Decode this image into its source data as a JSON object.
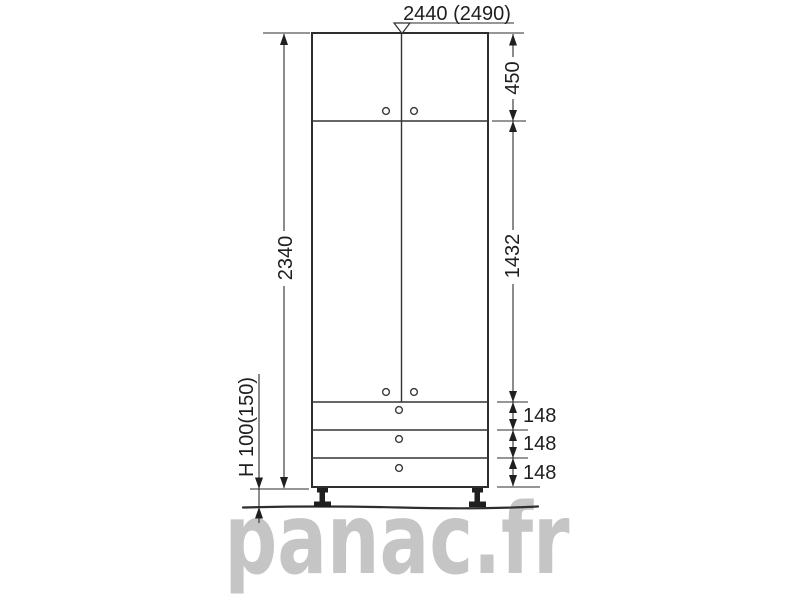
{
  "drawing": {
    "line_color": "#2e2e2e",
    "top_dimension_label": "2440 (2490)",
    "right_dimensions": {
      "upper_doors_height": "450",
      "tall_doors_height": "1432",
      "drawer_heights": [
        "148",
        "148",
        "148"
      ]
    },
    "left_dimensions": {
      "cabinet_body_height": "2340",
      "leg_height": "H 100(150)"
    }
  },
  "watermark": {
    "text": "panac.fr",
    "color": "#c5c5c5"
  }
}
